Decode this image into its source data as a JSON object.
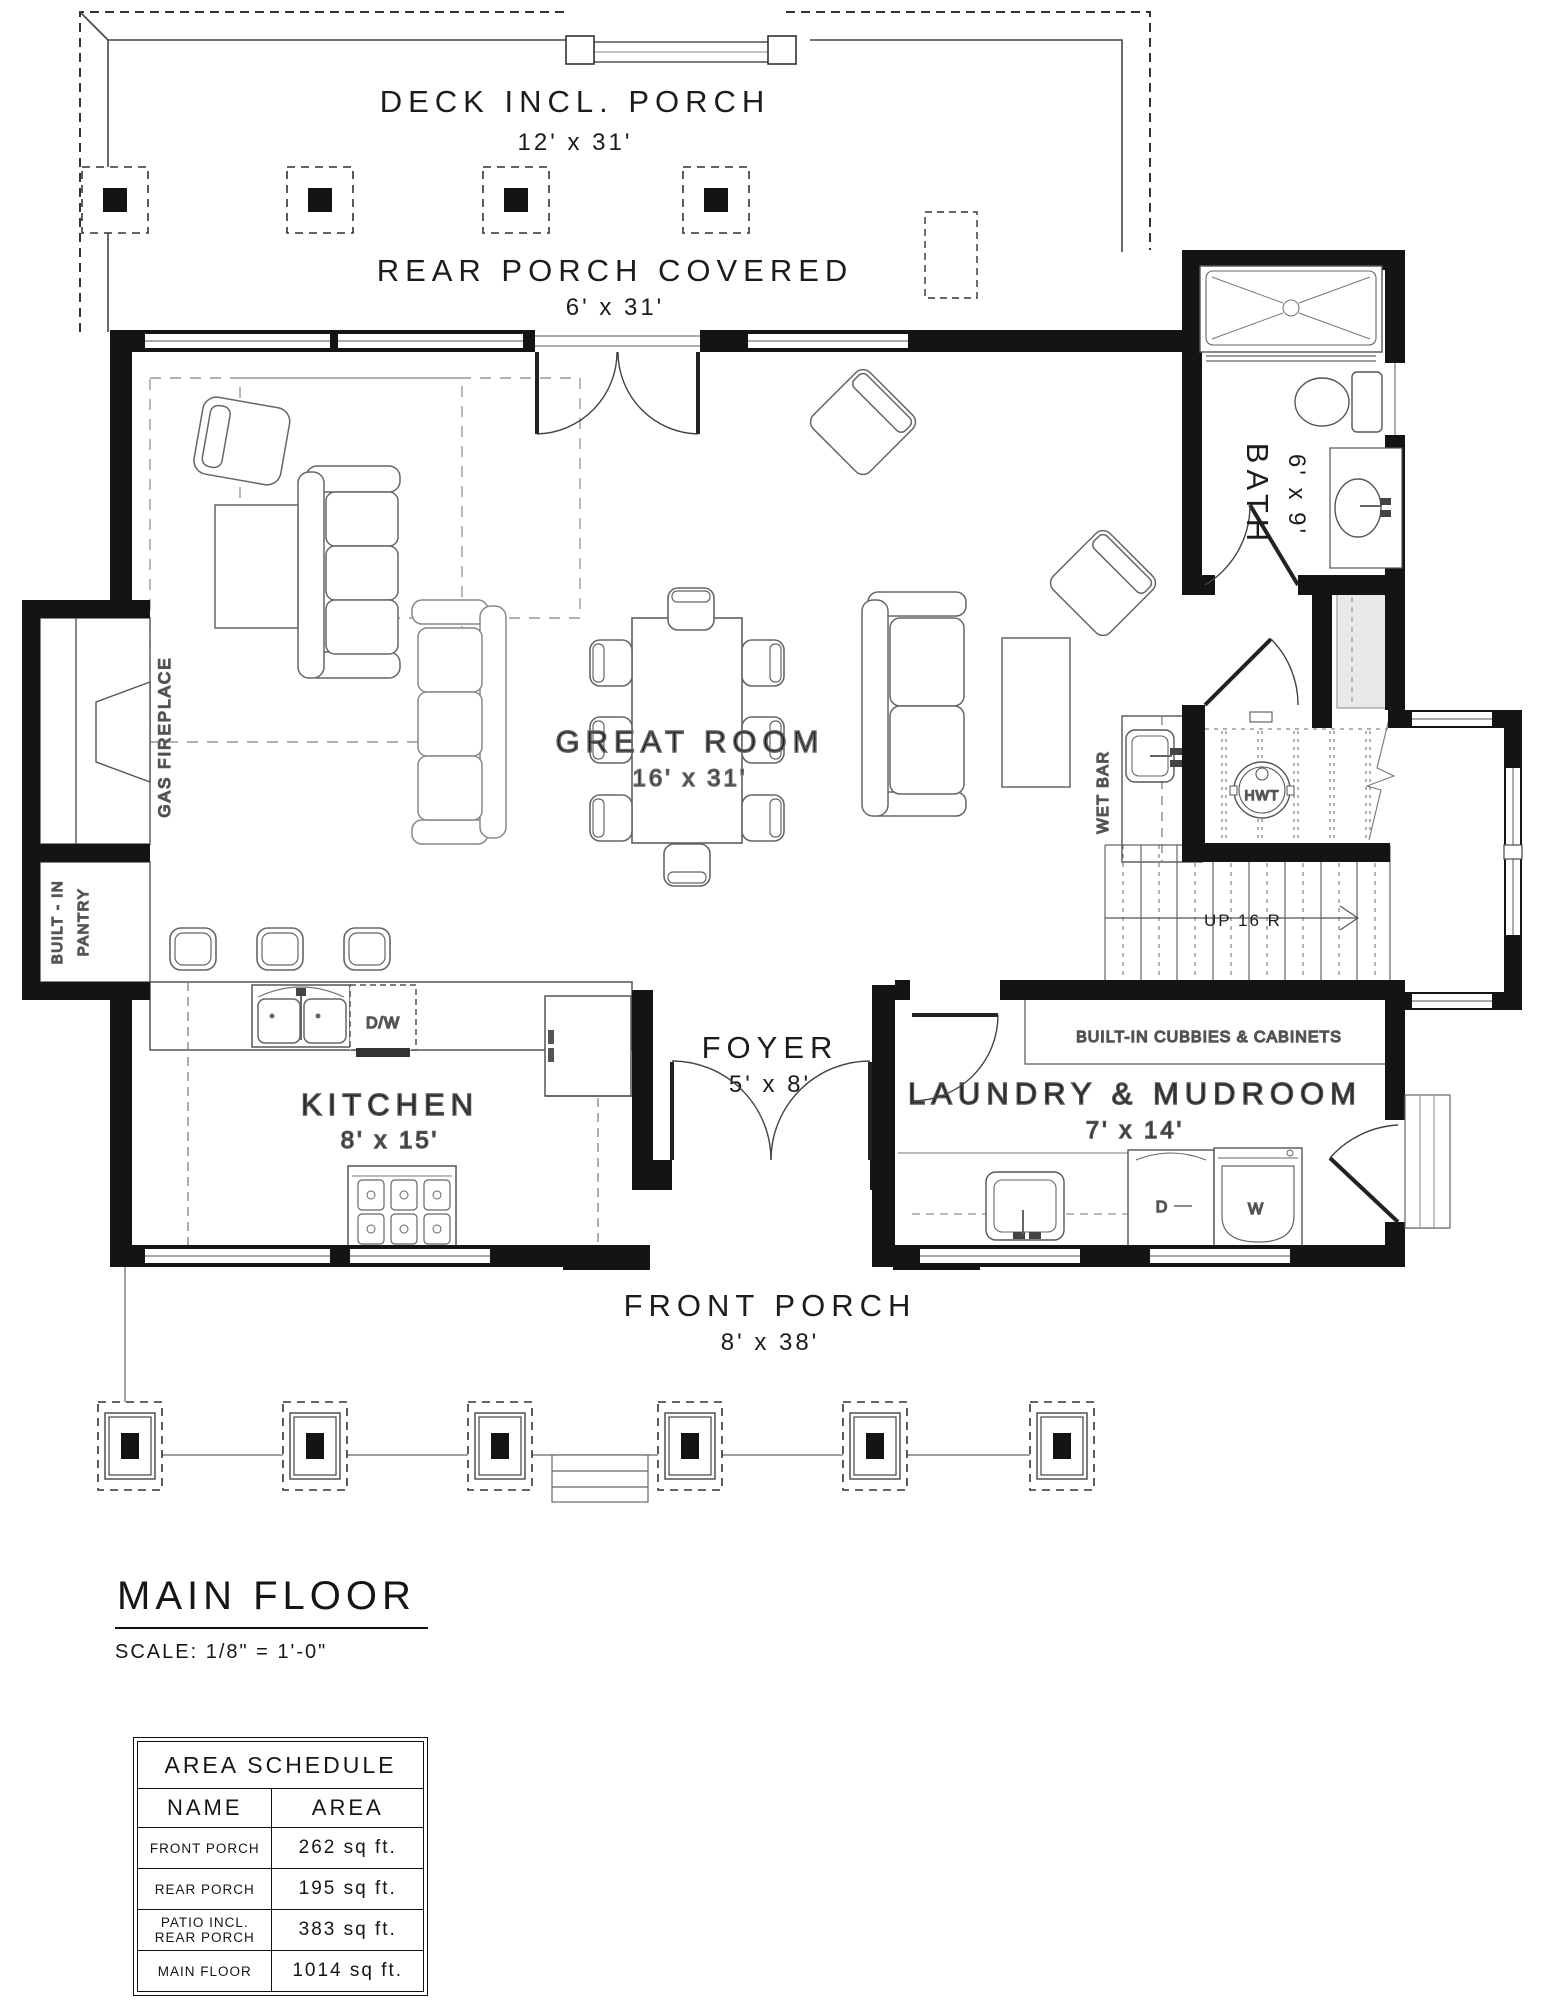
{
  "drawing": {
    "title": "MAIN FLOOR",
    "scale_note": "SCALE: 1/8\" = 1'-0\"",
    "rooms": {
      "deck": {
        "label": "DECK INCL. PORCH",
        "dims": "12' x 31'"
      },
      "rear_porch": {
        "label": "REAR PORCH COVERED",
        "dims": "6' x 31'"
      },
      "bath": {
        "label": "BATH",
        "dims": "6' x 9'"
      },
      "great_room": {
        "label": "GREAT ROOM",
        "dims": "16' x 31'"
      },
      "kitchen": {
        "label": "KITCHEN",
        "dims": "8' x 15'"
      },
      "foyer": {
        "label": "FOYER",
        "dims": "5' x 8'"
      },
      "laundry": {
        "label": "LAUNDRY & MUDROOM",
        "dims": "7' x 14'"
      },
      "front_porch": {
        "label": "FRONT PORCH",
        "dims": "8' x 38'"
      }
    },
    "labels": {
      "gas_fireplace": "GAS FIREPLACE",
      "pantry_line1": "BUILT - IN",
      "pantry_line2": "PANTRY",
      "wet_bar": "WET BAR",
      "water_tank": "HWT",
      "stairs": "UP 16 R",
      "cubbies": "BUILT-IN CUBBIES & CABINETS",
      "dishwasher": "D/W",
      "dryer": "D",
      "washer": "W"
    }
  },
  "area_schedule": {
    "title": "AREA SCHEDULE",
    "columns": {
      "name": "NAME",
      "area": "AREA"
    },
    "rows": [
      {
        "name": "FRONT PORCH",
        "name2": "",
        "area": "262 sq ft."
      },
      {
        "name": "REAR PORCH",
        "name2": "",
        "area": "195 sq ft."
      },
      {
        "name": "PATIO INCL.",
        "name2": "REAR PORCH",
        "area": "383 sq ft."
      },
      {
        "name": "MAIN FLOOR",
        "name2": "",
        "area": "1014 sq ft."
      }
    ]
  }
}
